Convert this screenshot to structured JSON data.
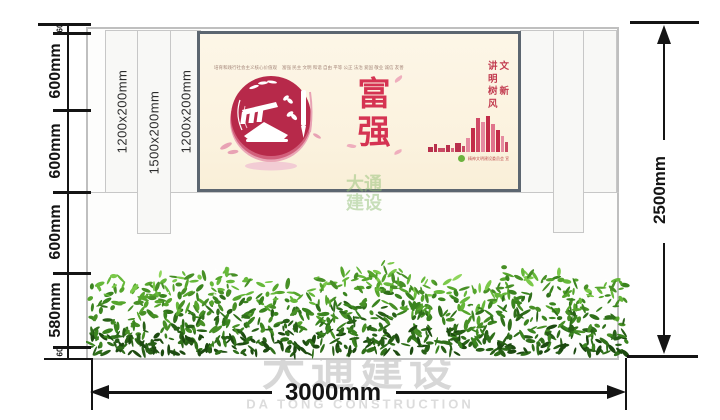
{
  "left_dimension": {
    "segments": [
      "60",
      "600mm",
      "600mm",
      "600mm",
      "580mm",
      "60"
    ]
  },
  "right_dimension": {
    "label": "2500mm"
  },
  "bottom_dimension": {
    "label": "3000mm"
  },
  "columns": {
    "labels": [
      "1200x200mm",
      "1500x200mm",
      "1200x200mm"
    ]
  },
  "poster": {
    "values_heading": "培育和践行社会主义核心价值观",
    "values_words": "富强 民主 文明 和谐 自由 平等 公正 法治 爱国 敬业 诚信 友善",
    "slogan": "讲文明\n树新风",
    "theme_char_top": "富",
    "theme_char_bottom": "强",
    "footer_credit": "精神文明建设委员会 宣"
  },
  "watermarks": {
    "main_cn": "大通建设",
    "main_en": "DA TONG CONSTRUCTION",
    "poster_cn": "大通建设"
  },
  "colors": {
    "accent_red": "#c22c48",
    "poster_bg": "#fbf3e2",
    "hedge_green": "#3f8c22",
    "dimension_black": "#141414"
  }
}
